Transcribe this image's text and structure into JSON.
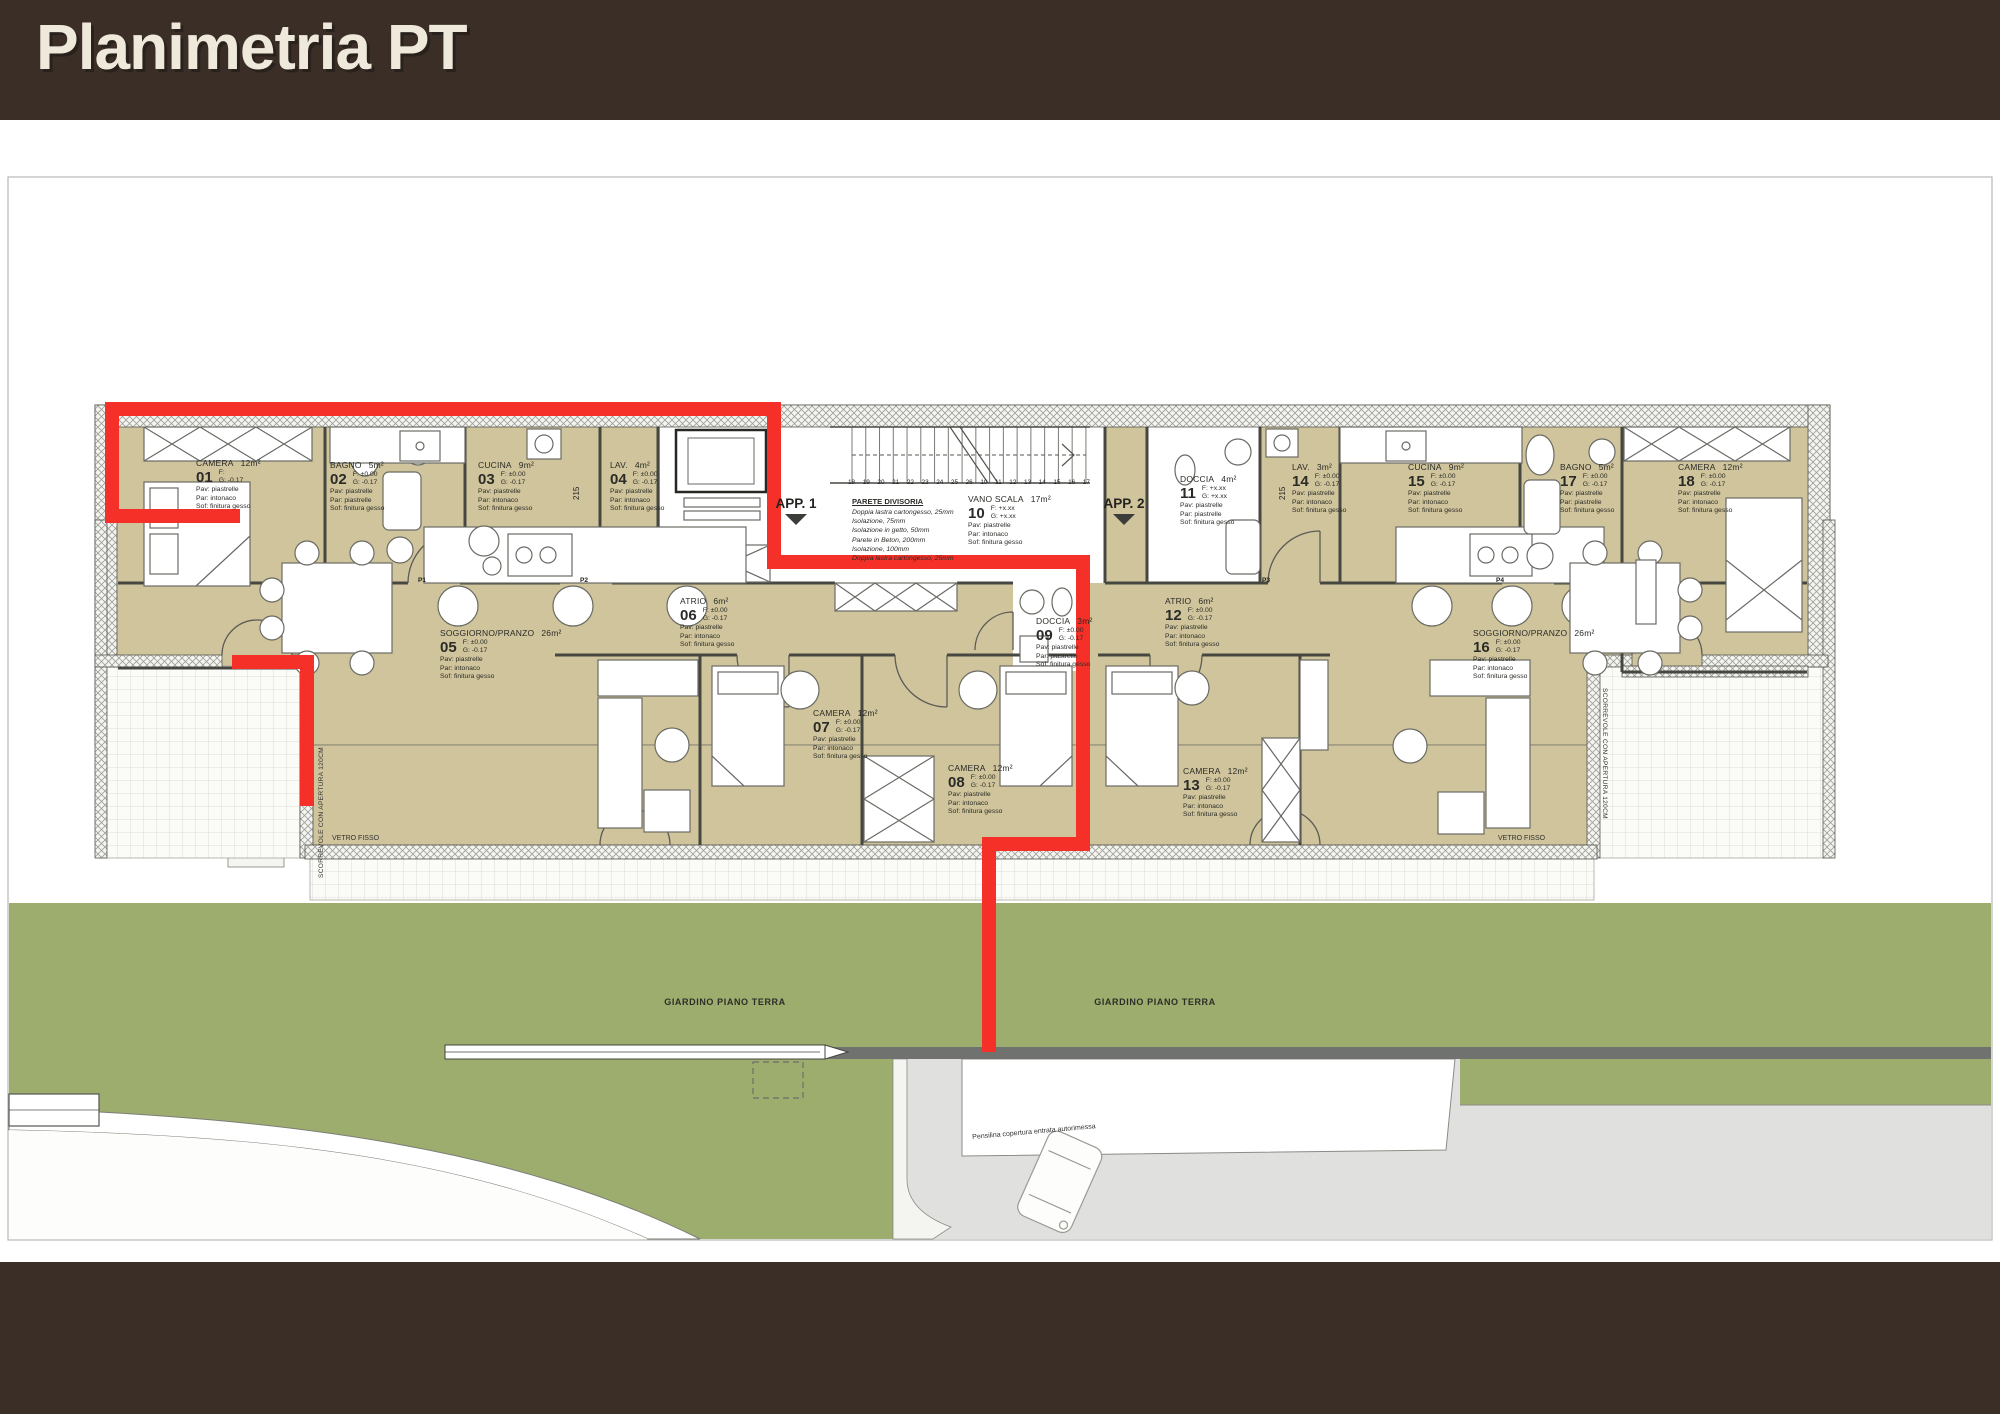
{
  "header": {
    "title": "Planimetria PT"
  },
  "colors": {
    "brown": "#3a2e27",
    "cream": "#efe9dc",
    "room_fill": "#cfc49b",
    "garden_green": "#9cad6e",
    "highlight_red": "#f43028",
    "wall_band_gray": "#70726f",
    "driveway_gray": "#e0e1de"
  },
  "labels": {
    "f": "F:",
    "g": "G:",
    "pav": "Pav:",
    "par": "Par:",
    "sof": "Sof:"
  },
  "apartments": [
    {
      "label": "APP. 1"
    },
    {
      "label": "APP. 2"
    }
  ],
  "rooms": [
    {
      "num": "01",
      "name": "CAMERA",
      "area": "12m²",
      "f": "",
      "g": "-0.17",
      "pav": "piastrelle",
      "par": "intonaco",
      "sof": "finitura gesso"
    },
    {
      "num": "02",
      "name": "BAGNO",
      "area": "5m²",
      "f": "±0.00",
      "g": "-0.17",
      "pav": "piastrelle",
      "par": "piastrelle",
      "sof": "finitura gesso"
    },
    {
      "num": "03",
      "name": "CUCINA",
      "area": "9m²",
      "f": "±0.00",
      "g": "-0.17",
      "pav": "piastrelle",
      "par": "intonaco",
      "sof": "finitura gesso"
    },
    {
      "num": "04",
      "name": "LAV.",
      "area": "4m²",
      "f": "±0.00",
      "g": "-0.17",
      "pav": "piastrelle",
      "par": "intonaco",
      "sof": "finitura gesso"
    },
    {
      "num": "05",
      "name": "SOGGIORNO/PRANZO",
      "area": "26m²",
      "f": "±0.00",
      "g": "-0.17",
      "pav": "piastrelle",
      "par": "intonaco",
      "sof": "finitura gesso"
    },
    {
      "num": "06",
      "name": "ATRIO",
      "area": "6m²",
      "f": "±0.00",
      "g": "-0.17",
      "pav": "piastrelle",
      "par": "intonaco",
      "sof": "finitura gesso"
    },
    {
      "num": "07",
      "name": "CAMERA",
      "area": "12m²",
      "f": "±0.00",
      "g": "-0.17",
      "pav": "piastrelle",
      "par": "intonaco",
      "sof": "finitura gesso"
    },
    {
      "num": "08",
      "name": "CAMERA",
      "area": "12m²",
      "f": "±0.00",
      "g": "-0.17",
      "pav": "piastrelle",
      "par": "intonaco",
      "sof": "finitura gesso"
    },
    {
      "num": "09",
      "name": "DOCCIA",
      "area": "3m²",
      "f": "±0.00",
      "g": "-0.17",
      "pav": "piastrelle",
      "par": "piastrelle",
      "sof": "finitura gesso"
    },
    {
      "num": "10",
      "name": "VANO SCALA",
      "area": "17m²",
      "f": "+x.xx",
      "g": "+x.xx",
      "pav": "piastrelle",
      "par": "intonaco",
      "sof": "finitura gesso"
    },
    {
      "num": "11",
      "name": "DOCCIA",
      "area": "4m²",
      "f": "+x.xx",
      "g": "+x.xx",
      "pav": "piastrelle",
      "par": "piastrelle",
      "sof": "finitura gesso"
    },
    {
      "num": "12",
      "name": "ATRIO",
      "area": "6m²",
      "f": "±0.00",
      "g": "-0.17",
      "pav": "piastrelle",
      "par": "intonaco",
      "sof": "finitura gesso"
    },
    {
      "num": "13",
      "name": "CAMERA",
      "area": "12m²",
      "f": "±0.00",
      "g": "-0.17",
      "pav": "piastrelle",
      "par": "intonaco",
      "sof": "finitura gesso"
    },
    {
      "num": "14",
      "name": "LAV.",
      "area": "3m²",
      "f": "±0.00",
      "g": "-0.17",
      "pav": "piastrelle",
      "par": "intonaco",
      "sof": "finitura gesso"
    },
    {
      "num": "15",
      "name": "CUCINA",
      "area": "9m²",
      "f": "±0.00",
      "g": "-0.17",
      "pav": "piastrelle",
      "par": "intonaco",
      "sof": "finitura gesso"
    },
    {
      "num": "16",
      "name": "SOGGIORNO/PRANZO",
      "area": "26m²",
      "f": "±0.00",
      "g": "-0.17",
      "pav": "piastrelle",
      "par": "intonaco",
      "sof": "finitura gesso"
    },
    {
      "num": "17",
      "name": "BAGNO",
      "area": "5m²",
      "f": "±0.00",
      "g": "-0.17",
      "pav": "piastrelle",
      "par": "piastrelle",
      "sof": "finitura gesso"
    },
    {
      "num": "18",
      "name": "CAMERA",
      "area": "12m²",
      "f": "±0.00",
      "g": "-0.17",
      "pav": "piastrelle",
      "par": "intonaco",
      "sof": "finitura gesso"
    }
  ],
  "parete_divisoria": {
    "title": "PARETE DIVISORIA",
    "lines": [
      "Doppia lastra cartongesso, 25mm",
      "Isolazione, 75mm",
      "Isolazione in getto, 50mm",
      "Parete in Beton, 200mm",
      "Isolazione, 100mm",
      "Doppia lastra cartongesso, 25mm"
    ]
  },
  "stairs": {
    "steps": [
      "18",
      "19",
      "20",
      "21",
      "22",
      "23",
      "24",
      "25",
      "26",
      "10",
      "11",
      "12",
      "13",
      "14",
      "15",
      "16",
      "17"
    ]
  },
  "annotations": {
    "giardino": "GIARDINO PIANO TERRA",
    "vetro_fisso": "VETRO FISSO",
    "scorrevole": "SCORREVOLE CON APERTURA 120CM",
    "pensilina": "Pensilina copertura entrata autorimessa",
    "dim_door": "215",
    "door_tags": [
      "P1",
      "P2",
      "P3",
      "P4"
    ]
  }
}
